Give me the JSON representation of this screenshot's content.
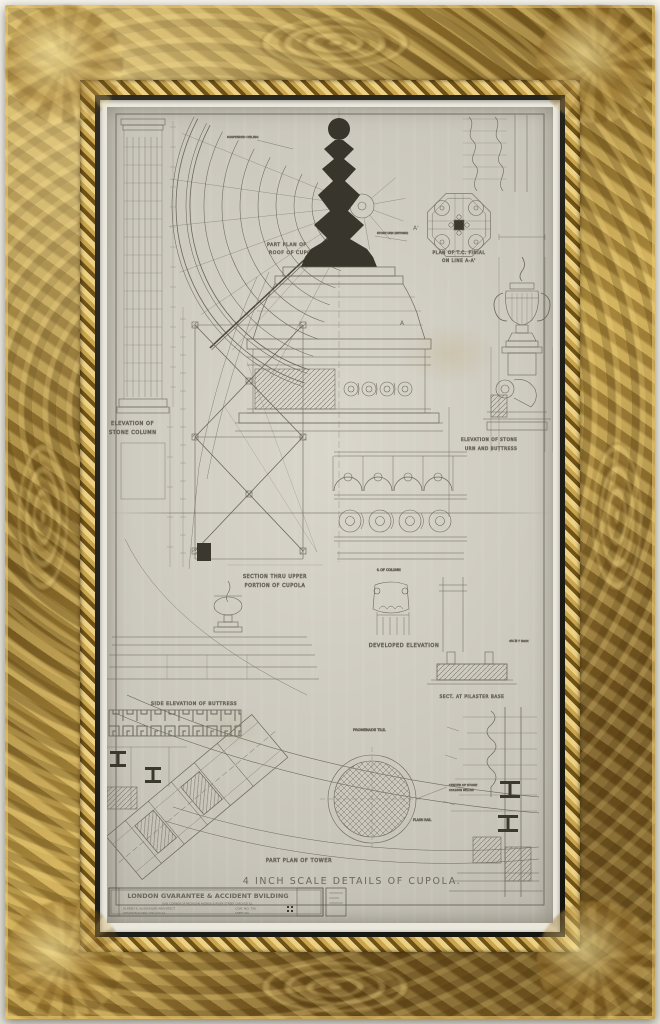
{
  "artwork": {
    "description": "Framed architectural drawing, gold ornate frame",
    "frame_color": "#a2813a",
    "liner_color": "#1f1d17",
    "mat_color": "#eae8dd",
    "paper_color": "#cdcabf",
    "ink_color": "#6b675a"
  },
  "titles": {
    "main": "4 INCH SCALE DETAILS OF CUPOLA.",
    "part_plan_tower": "PART PLAN OF TOWER"
  },
  "labels": {
    "roof_plan": [
      "PART PLAN OF",
      "ROOF OF CUPOLA"
    ],
    "ceiling_note": "SUSPENDED CEILING",
    "finial_plan": [
      "PLAN OF T.C. FINIAL",
      "ON LINE A-A'"
    ],
    "stone_column": [
      "ELEVATION OF",
      "STONE COLUMN"
    ],
    "urn": [
      "ELEVATION OF STONE",
      "URN AND BUTTRESS"
    ],
    "urn_beyond": "STONE URN (BEYOND)",
    "section": [
      "SECTION THRU UPPER",
      "PORTION OF CUPOLA"
    ],
    "developed": "DEVELOPED ELEVATION",
    "buttress": "SIDE ELEVATION OF BUTTRESS",
    "pilaster_base": "SECT. AT PILASTER BASE",
    "centerline_column": "℄ OF COLUMN",
    "t_iron": "4½ ℔ T IRON",
    "flash_rail": "FLASH RAIL",
    "promenade_tile": "PROMENADE TILE.",
    "column_below": [
      "CENTER OF STONE",
      "COLUMN BELOW"
    ],
    "marker_a": "A",
    "marker_a2": "A'"
  },
  "title_block": {
    "building": "LONDON GVARANTEE & ACCIDENT BVILDING",
    "address": "N.W. CORNER OF MICHIGAN AVENUE & RIVER STREET CHICAGO ILL.",
    "architect": "ALFRED S. ALSCHULER   ARCHITECT",
    "commission": "COM. NO. 750",
    "office": "STEGER BUILDING   CHICAGO ILL.",
    "sheet": "SHEET NO."
  }
}
